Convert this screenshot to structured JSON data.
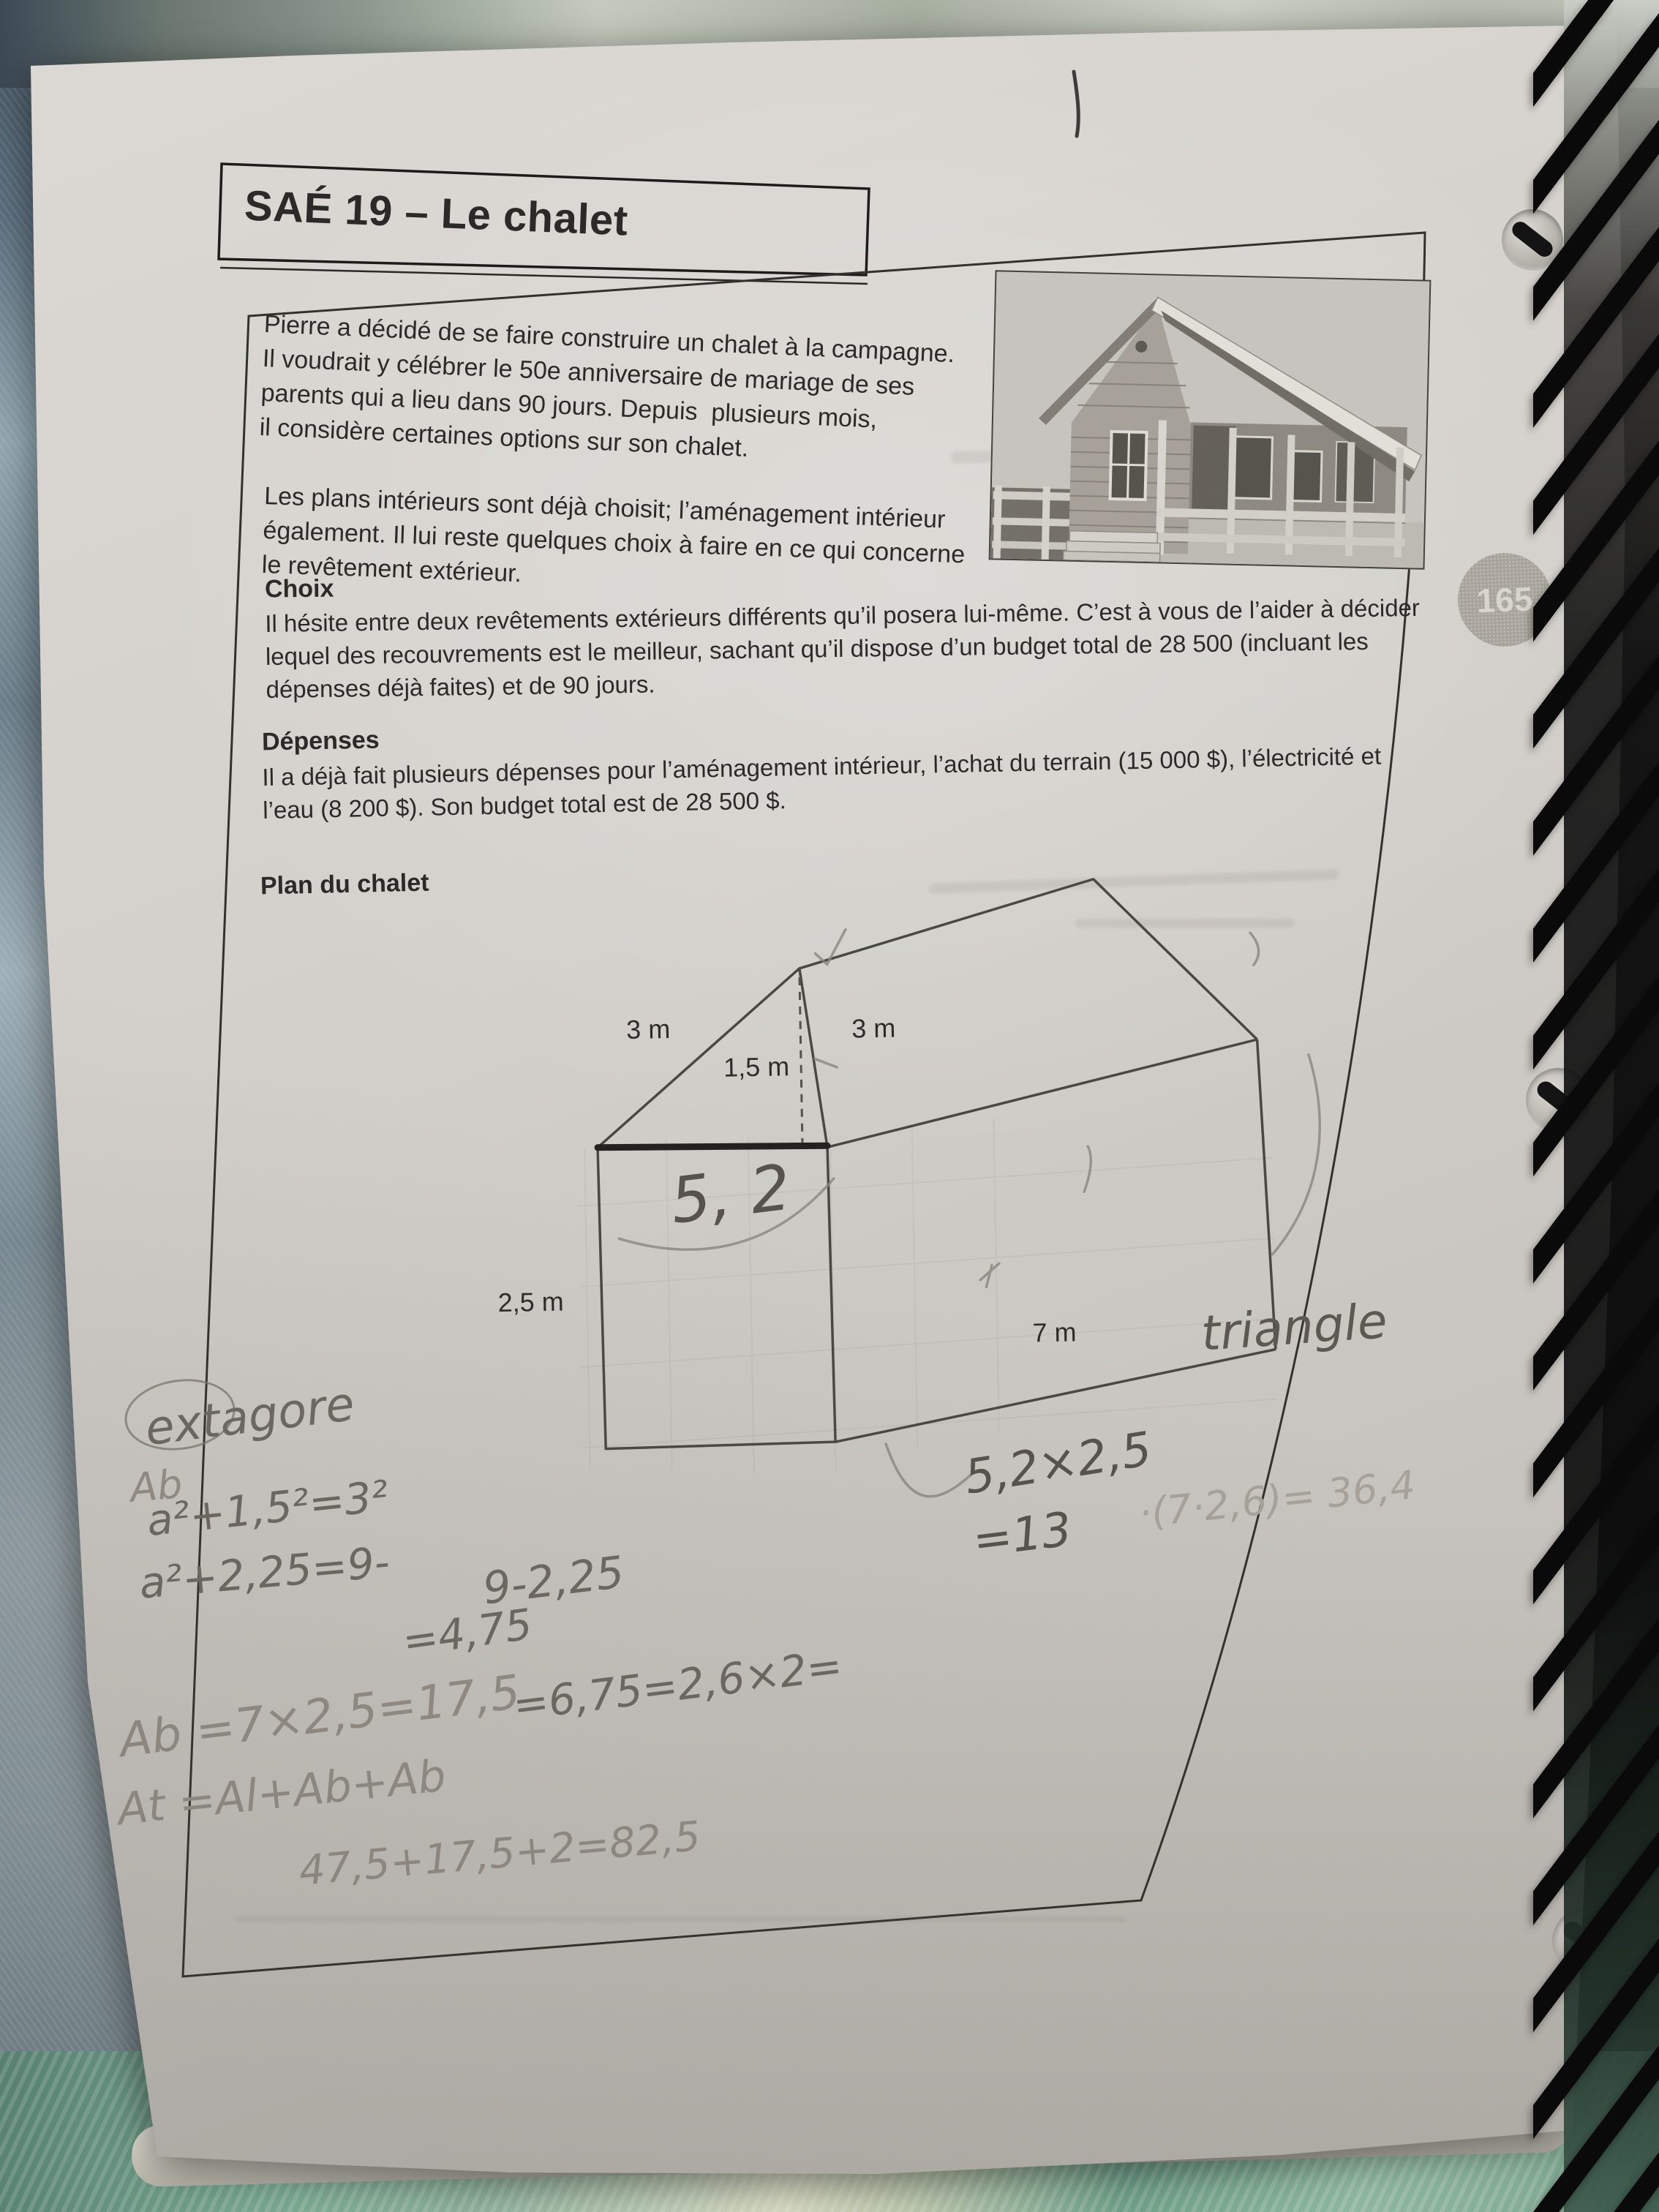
{
  "page": {
    "number": "165",
    "title": "SAÉ 19 – Le chalet"
  },
  "intro": {
    "para1": [
      "Pierre a décidé de se faire construire un chalet à la campagne.",
      "Il voudrait y célébrer le 50e anniversaire de mariage de ses",
      "parents qui a lieu dans 90 jours. Depuis  plusieurs mois,",
      "il considère certaines options sur son chalet."
    ],
    "para2": [
      "Les plans intérieurs sont déjà choisit; l’aménagement intérieur",
      "également. Il lui reste quelques choix à faire en ce qui concerne",
      "le revêtement extérieur."
    ]
  },
  "choix": {
    "heading": "Choix",
    "lines": [
      "Il hésite entre deux revêtements extérieurs différents qu’il posera lui-même. C’est à vous de l’aider à décider",
      "lequel des recouvrements est le meilleur, sachant qu’il dispose d’un budget total de 28 500 (incluant les",
      "dépenses déjà faites) et de 90 jours."
    ]
  },
  "depenses": {
    "heading": "Dépenses",
    "lines": [
      "Il a déjà fait plusieurs dépenses pour l’aménagement intérieur, l’achat du terrain (15 000 $), l’électricité et",
      "l’eau (8 200 $). Son budget total est de 28 500 $."
    ]
  },
  "plan": {
    "heading": "Plan du chalet",
    "labels": {
      "roof_left": "3 m",
      "roof_right": "3 m",
      "ridge_height": "1,5 m",
      "wall_height": "2,5 m",
      "length": "7 m"
    },
    "pencil_width": "5, 2"
  },
  "handwriting": {
    "pythagore": "extagore",
    "ghost": "Ab",
    "eq1": "a²+1,5²=3²",
    "eq2": "a²+2,25=9-",
    "eq3": "9-2,25",
    "eq4": "=4,75",
    "eq5": "=6,75=2,6×2=",
    "area_base": "Ab =7×2,5=17,5",
    "area_total": "At =Al+Ab+Ab",
    "sum": "47,5+17,5+2=82,5",
    "triangle": "triangle",
    "mult": "5,2×2,5",
    "mult_result": "=13",
    "faint_calc": "·(7·2,6)= 36,4"
  }
}
